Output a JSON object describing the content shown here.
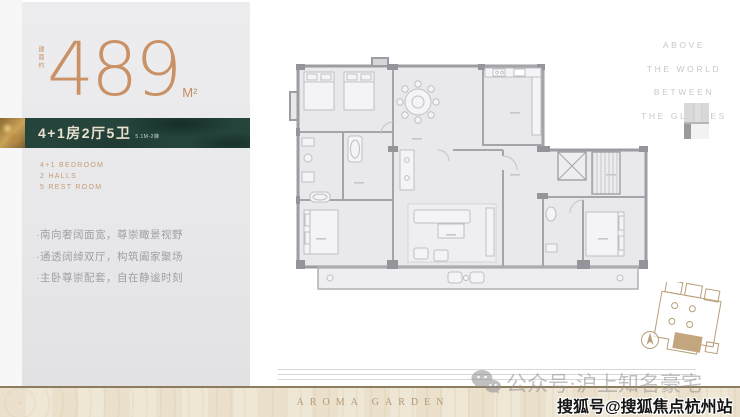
{
  "left_panel": {
    "area": {
      "prefix_vertical": "建面约",
      "value": "489",
      "unit": "M²"
    },
    "banner": {
      "title": "4+1房2厅5卫",
      "subtitle": "5.1M-2梯"
    },
    "specs": [
      "4+1 BEDROOM",
      "2 HALLS",
      "5 REST ROOM"
    ],
    "bullets": [
      "·南向奢阔面宽，尊崇瞰景视野",
      "·通透阔绰双厅，构筑阖家聚场",
      "·主卧尊崇配套，自在静谧时刻"
    ]
  },
  "slogan": {
    "lines": [
      "ABOVE",
      "THE WORLD",
      "BETWEEN",
      "THE GLORIES"
    ]
  },
  "footer": {
    "brand": "AROMA GARDEN"
  },
  "watermarks": {
    "wechat_account": "公众号·沪上知名豪宅",
    "sohu_account": "搜狐号@搜狐焦点杭州站"
  },
  "colors": {
    "bronze": "#c89064",
    "deep_green": "#25443c",
    "cream_text": "#eae1cf",
    "footer_beige": "#efe7d6",
    "wall_gray": "#9c9ca2",
    "keyplan_tan": "#b79f78"
  }
}
